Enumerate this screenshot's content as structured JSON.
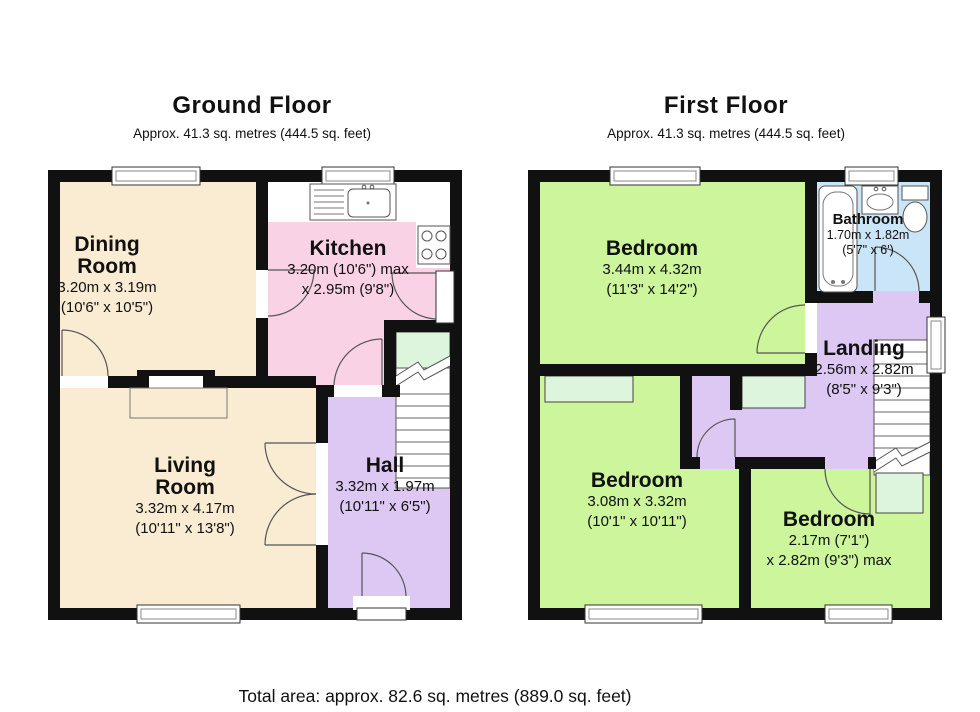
{
  "colors": {
    "wall": "#111111",
    "cream": "#faebd3",
    "pink": "#fad2e6",
    "lavender": "#dcc8f2",
    "green": "#ccf59c",
    "blue": "#c9e5f7",
    "mint": "#ddf5dc"
  },
  "ground": {
    "title": "Ground Floor",
    "subtitle": "Approx. 41.3 sq. metres (444.5 sq. feet)",
    "rooms": {
      "dining": {
        "l1": "Dining",
        "l2": "Room",
        "d1": "3.20m x 3.19m",
        "d2": "(10'6\" x 10'5\")"
      },
      "kitchen": {
        "l1": "Kitchen",
        "d1": "3.20m (10'6\") max",
        "d2": "x 2.95m (9'8\")"
      },
      "living": {
        "l1": "Living",
        "l2": "Room",
        "d1": "3.32m x 4.17m",
        "d2": "(10'11\" x 13'8\")"
      },
      "hall": {
        "l1": "Hall",
        "d1": "3.32m x 1.97m",
        "d2": "(10'11\" x 6'5\")"
      }
    }
  },
  "first": {
    "title": "First Floor",
    "subtitle": "Approx. 41.3 sq. metres (444.5 sq. feet)",
    "rooms": {
      "bedroom1": {
        "l1": "Bedroom",
        "d1": "3.44m x 4.32m",
        "d2": "(11'3\" x 14'2\")"
      },
      "bathroom": {
        "l1": "Bathroom",
        "d1": "1.70m x 1.82m",
        "d2": "(5'7\" x 6')"
      },
      "landing": {
        "l1": "Landing",
        "d1": "2.56m x 2.82m",
        "d2": "(8'5\" x 9'3\")"
      },
      "bedroom2": {
        "l1": "Bedroom",
        "d1": "3.08m x 3.32m",
        "d2": "(10'1\" x 10'11\")"
      },
      "bedroom3": {
        "l1": "Bedroom",
        "d1": "2.17m (7'1\")",
        "d2": "x 2.82m (9'3\") max"
      }
    }
  },
  "footer": {
    "total": "Total area: approx. 82.6 sq. metres (889.0 sq. feet)"
  }
}
